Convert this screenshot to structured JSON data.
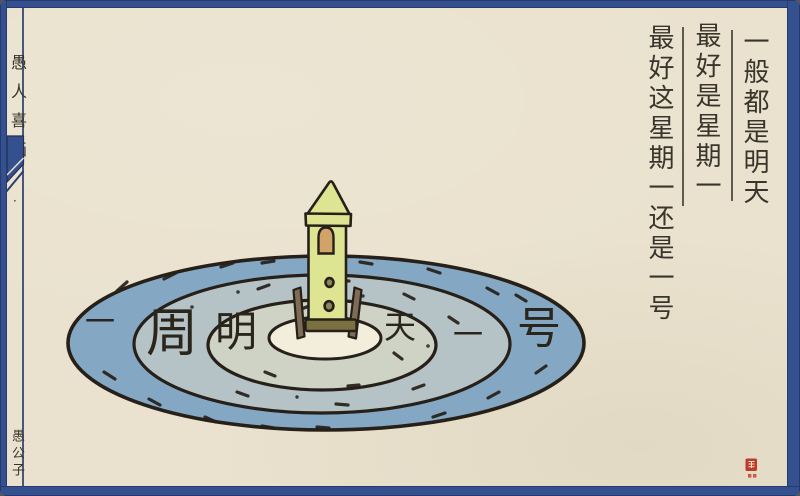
{
  "canvas": {
    "width": 800,
    "height": 496
  },
  "colors": {
    "paper": "#eae2ce",
    "frame": "#35508e",
    "rule": "#2c3f6e",
    "ink": "#262019",
    "text": "#3a352c",
    "ring-outer": "#84a8c3",
    "ring-mid": "#b5c3c7",
    "ring-inner": "#cfd3c5",
    "pad-center": "#f3eedc",
    "rocket-green": "#dde593",
    "rocket-base": "#7a7042",
    "window-tan": "#d2a369",
    "leg-brown": "#7f6c55",
    "seal-red": "#c03a28"
  },
  "margin": {
    "series_title": "愚人喜画",
    "dot": "·",
    "artist_signature": "愚公子"
  },
  "caption": {
    "columns": [
      {
        "text": "一般都是明天"
      },
      {
        "text": "最好是星期一"
      },
      {
        "text": "最好这星期一还是一号"
      }
    ]
  },
  "target": {
    "rings": [
      {
        "label_left": "一",
        "label_right": "号"
      },
      {
        "label_left": "周",
        "label_right": "一"
      },
      {
        "label_left": "明",
        "label_right": "天"
      }
    ]
  },
  "icons": {
    "ribbon": "corner-ribbon-ornament",
    "seal": "red-artist-seal",
    "rocket": "rocket-on-target-pad"
  }
}
